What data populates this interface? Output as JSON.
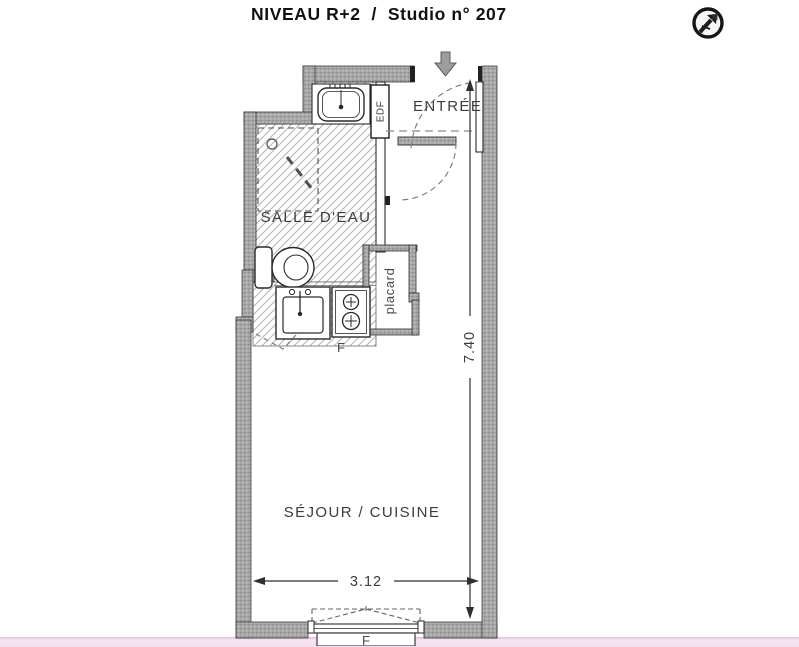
{
  "header": {
    "title": "NIVEAU R+2  /  Studio n° 207"
  },
  "north_badge": {
    "label": "N"
  },
  "rooms": {
    "entrance_label": "ENTRÉE",
    "bathroom_label": "SALLE D'EAU",
    "living_kitchen_label": "SÉJOUR / CUISINE",
    "closet_label": "placard",
    "utility_panel_label": "EDF",
    "fridge_label": "F",
    "window_label": "F"
  },
  "dimensions": {
    "vertical": "7.40",
    "horizontal": "3.12"
  },
  "colors": {
    "wall_fill": "#a8a8a8",
    "line": "#2f2f2f",
    "hatch_line": "#b3b3b3",
    "footer_strip": "#f5e2f0",
    "dashed": "#777777"
  }
}
